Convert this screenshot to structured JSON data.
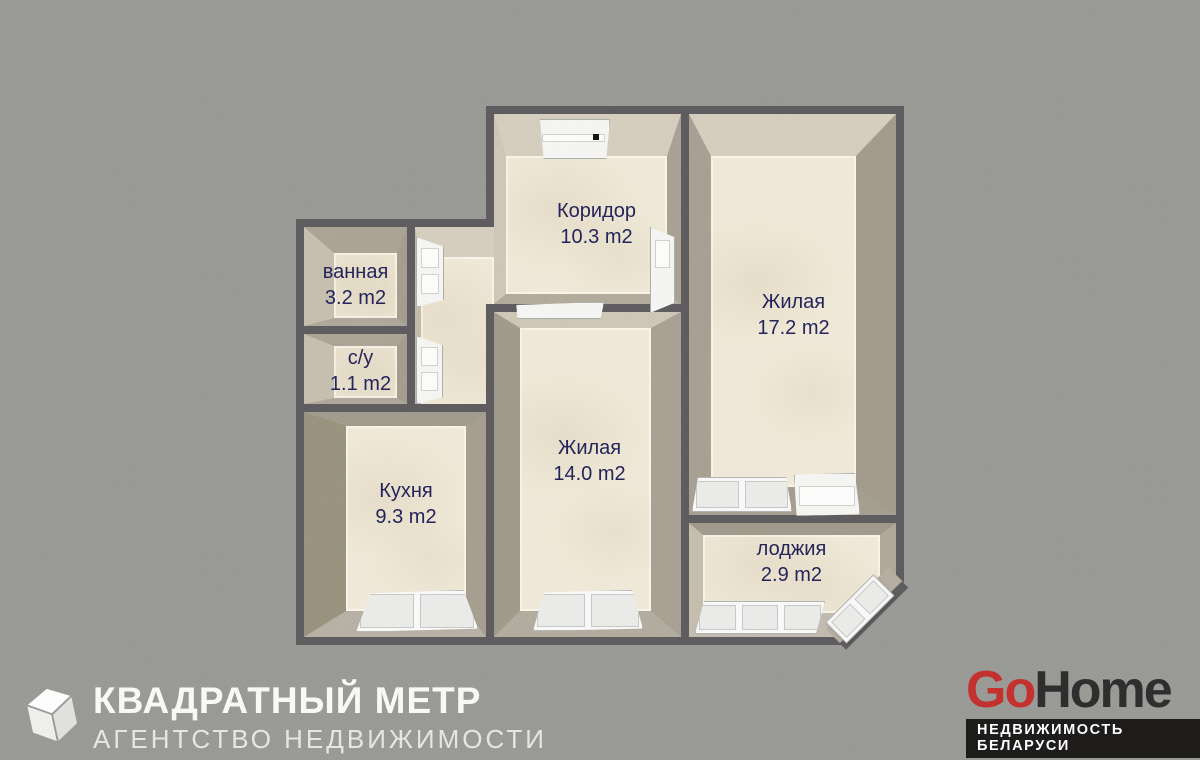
{
  "plan": {
    "rooms": [
      {
        "id": "corridor",
        "name": "Коридор",
        "area": "10.3 m2"
      },
      {
        "id": "bath",
        "name": "ванная",
        "area": "3.2 m2"
      },
      {
        "id": "wc",
        "name": "с/у",
        "area": "1.1 m2"
      },
      {
        "id": "kitchen",
        "name": "Кухня",
        "area": "9.3 m2"
      },
      {
        "id": "room14",
        "name": "Жилая",
        "area": "14.0 m2"
      },
      {
        "id": "room17",
        "name": "Жилая",
        "area": "17.2 m2"
      },
      {
        "id": "loggia",
        "name": "лоджия",
        "area": "2.9 m2"
      }
    ]
  },
  "branding": {
    "kvadratny_metr": {
      "title": "КВАДРАТНЫЙ МЕТР",
      "subtitle": "АГЕНТСТВО НЕДВИЖИМОСТИ",
      "icon": "cube-icon"
    },
    "gohome": {
      "go": "Go",
      "home": "Home",
      "tagline": "НЕДВИЖИМОСТЬ БЕЛАРУСИ"
    }
  },
  "colors": {
    "background": "#9a9a96",
    "wall": "#5e5c5e",
    "floor": "#f1ead9",
    "label_text": "#23235a",
    "gohome_red": "#c4302d",
    "gohome_dark": "#2e2c2c",
    "gohome_bar": "#1d1b19"
  }
}
